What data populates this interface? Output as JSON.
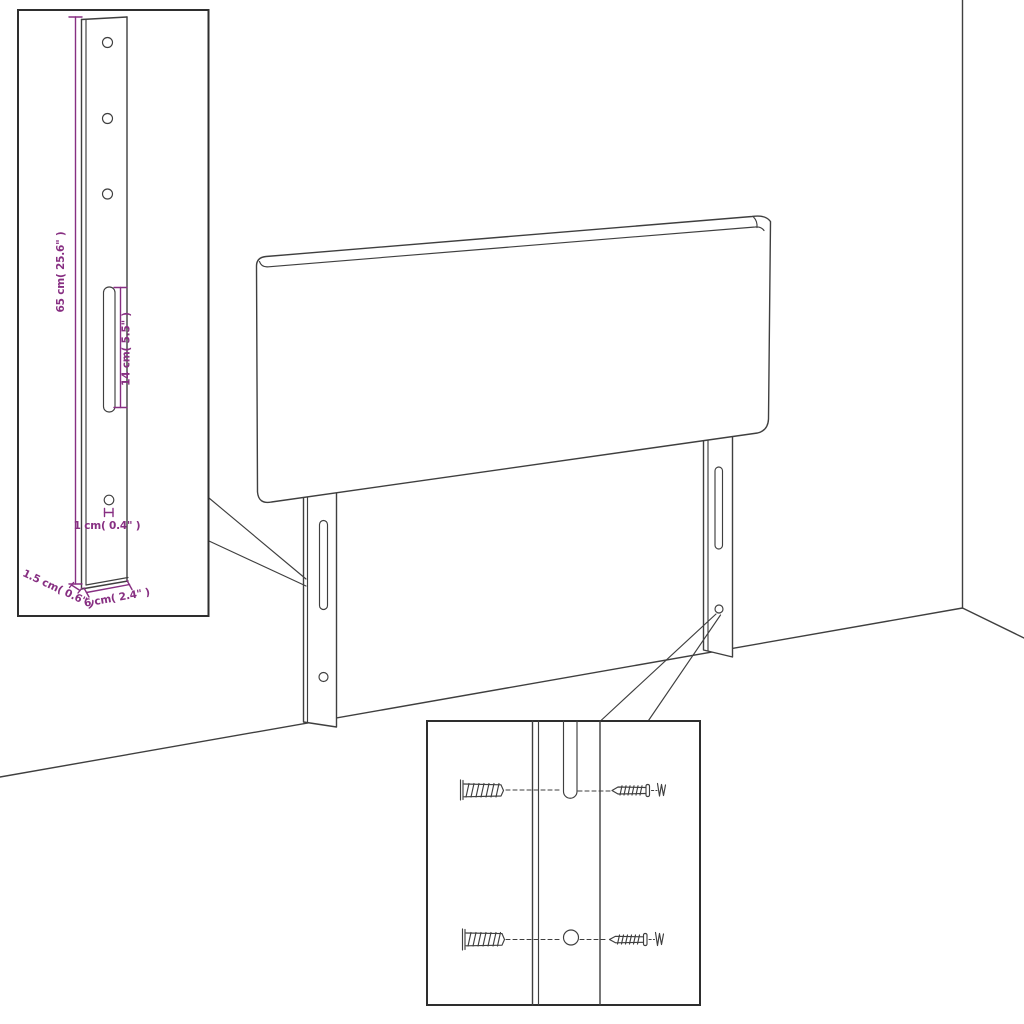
{
  "colors": {
    "background": "#ffffff",
    "line_art": "#3f3f3f",
    "dimension_annotation": "#872f82",
    "inset_border": "#2e2e2e"
  },
  "insets": {
    "bracket_detail": {
      "labels": {
        "height": "65 cm( 25.6\" )",
        "slot": "14 cm( 5.5\" )",
        "hole": "1 cm( 0.4\" )",
        "thickness": "1.5 cm( 0.6\" )",
        "width": "6 cm( 2.4\" )"
      }
    },
    "hardware_detail": {
      "icons": [
        "wall-plug-icon",
        "screw-icon",
        "wall-plug-icon",
        "screw-icon"
      ]
    }
  }
}
